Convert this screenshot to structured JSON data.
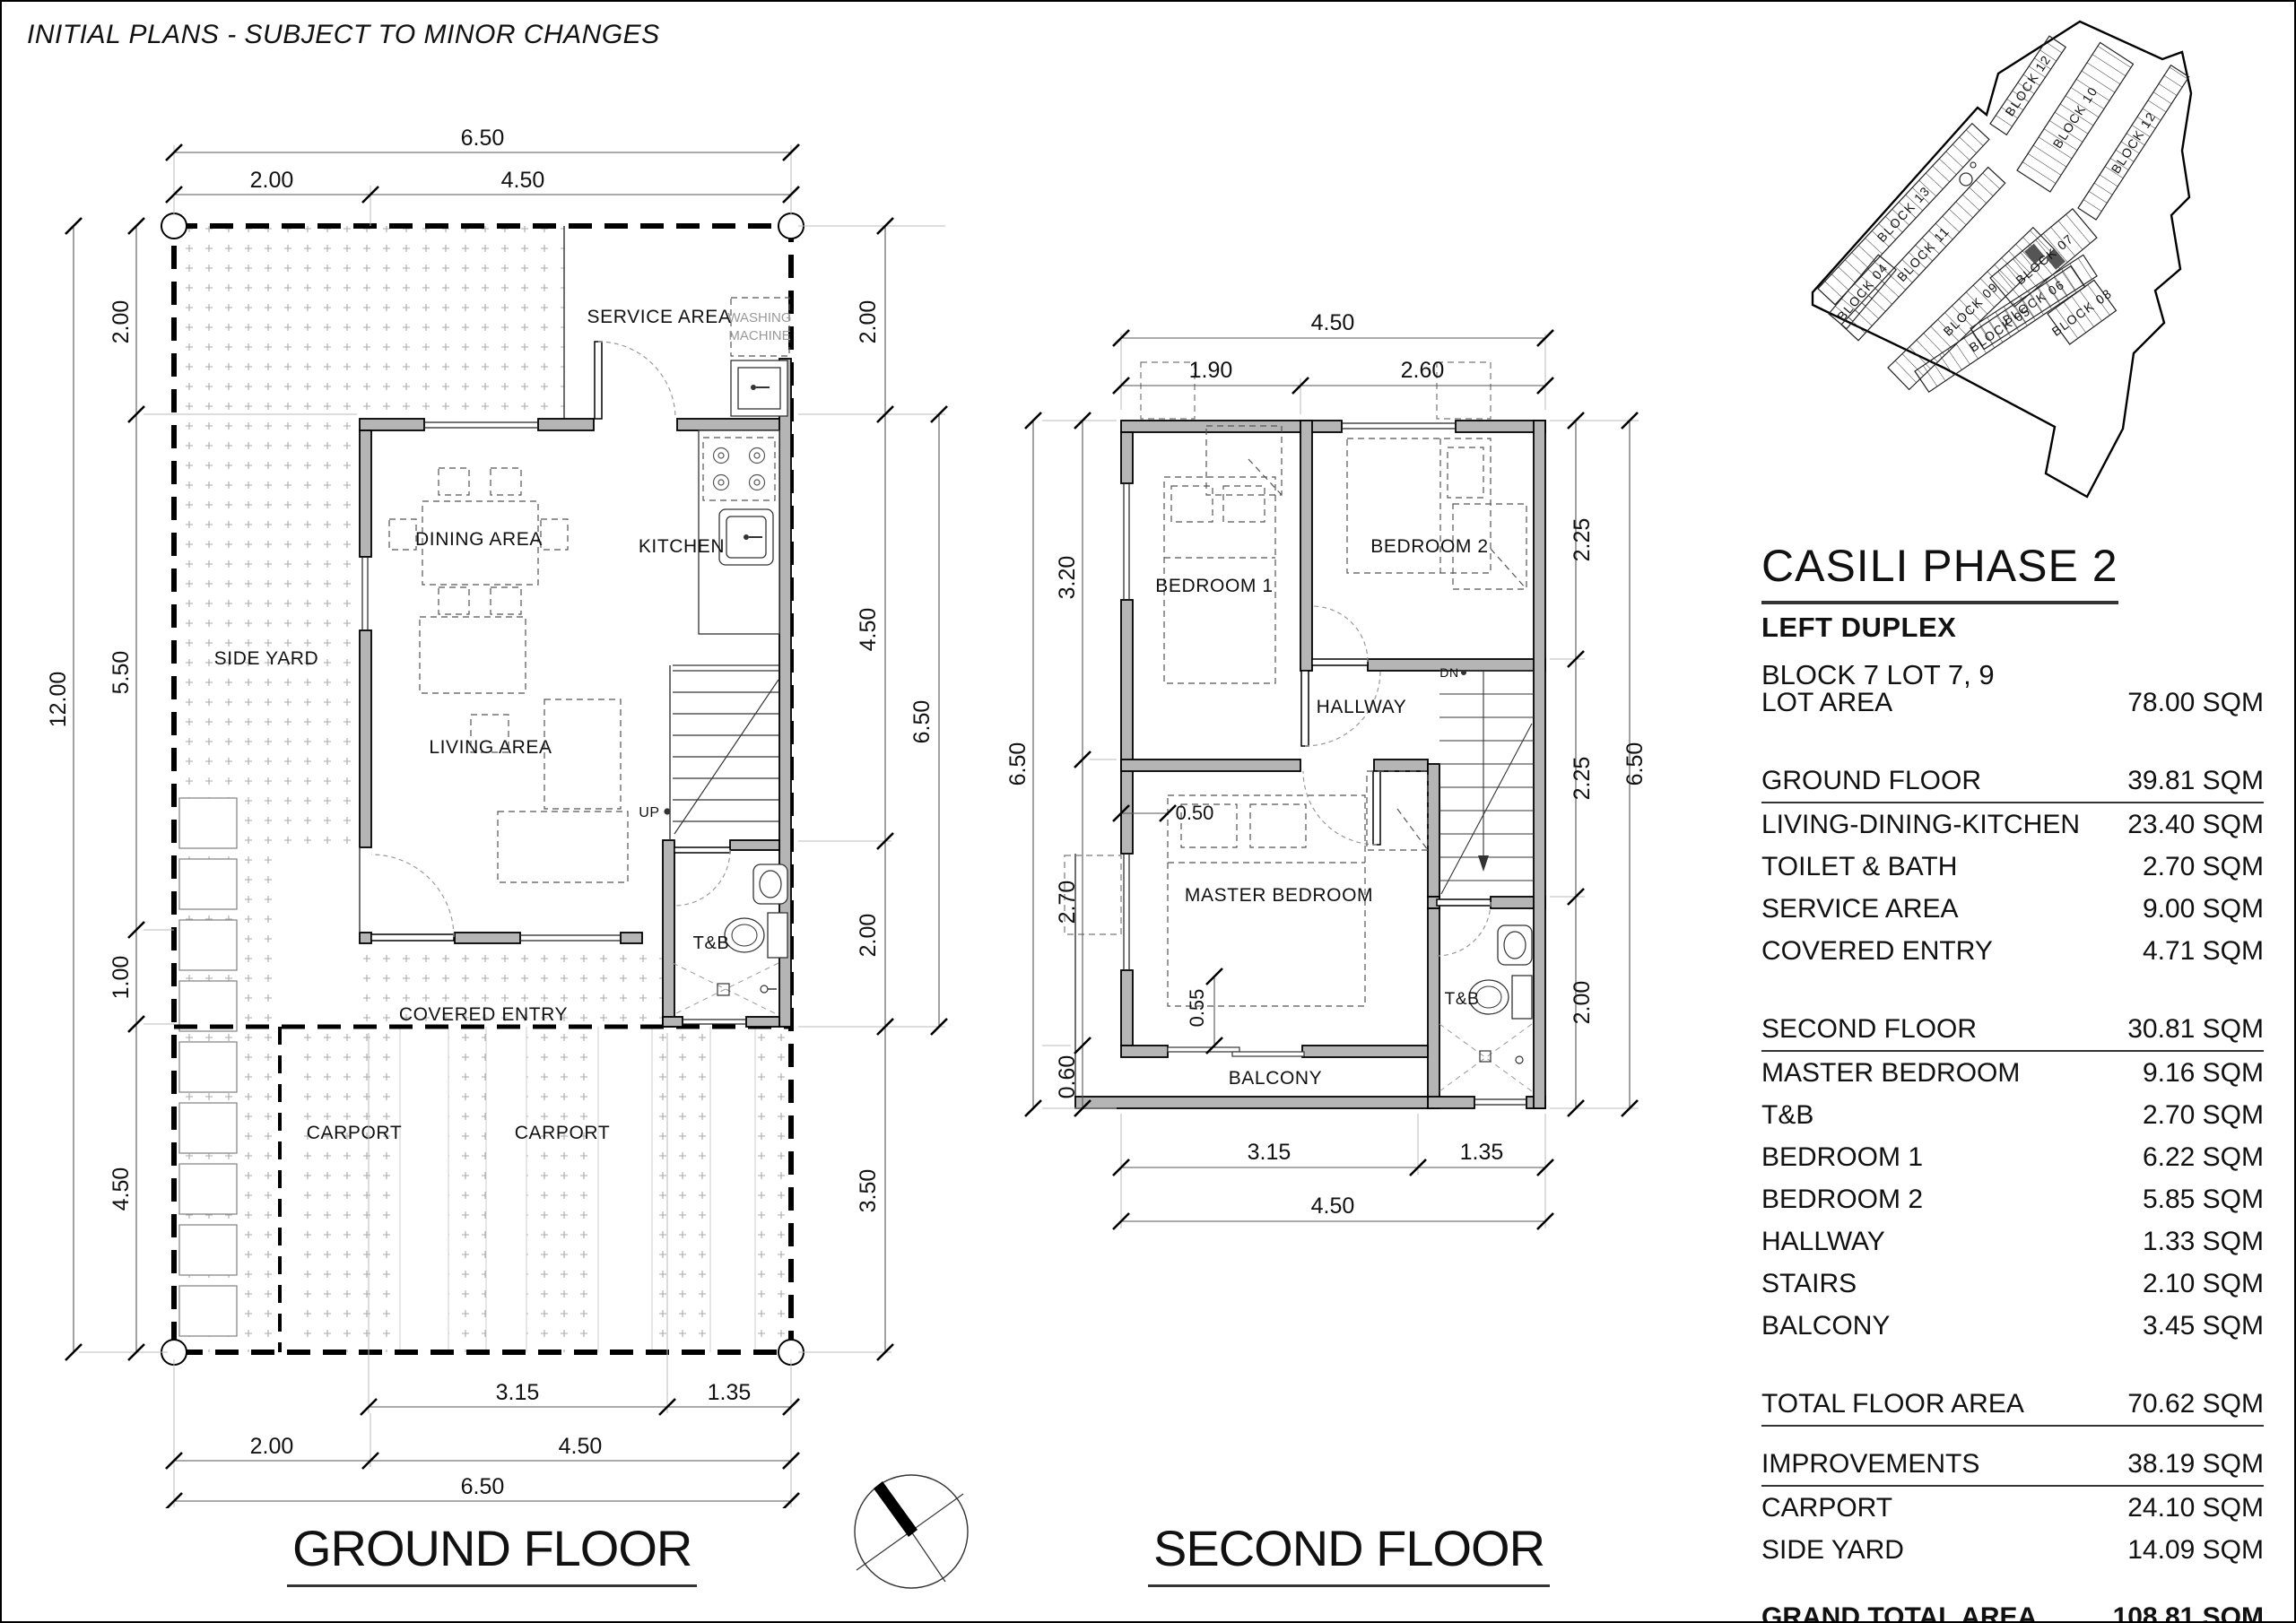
{
  "disclaimer": "INITIAL PLANS - SUBJECT TO MINOR CHANGES",
  "panel": {
    "title": "CASILI PHASE 2",
    "subtitle": "LEFT DUPLEX",
    "block_lot": "BLOCK 7 LOT 7, 9"
  },
  "table": {
    "rows": [
      {
        "label": "LOT AREA",
        "value": "78.00 SQM"
      },
      {
        "label": "GROUND FLOOR",
        "value": "39.81 SQM"
      },
      {
        "label": "LIVING-DINING-KITCHEN",
        "value": "23.40 SQM"
      },
      {
        "label": "TOILET & BATH",
        "value": "2.70 SQM"
      },
      {
        "label": "SERVICE AREA",
        "value": "9.00 SQM"
      },
      {
        "label": "COVERED ENTRY",
        "value": "4.71 SQM"
      },
      {
        "label": "SECOND FLOOR",
        "value": "30.81 SQM"
      },
      {
        "label": "MASTER BEDROOM",
        "value": "9.16 SQM"
      },
      {
        "label": "T&B",
        "value": "2.70 SQM"
      },
      {
        "label": "BEDROOM 1",
        "value": "6.22 SQM"
      },
      {
        "label": "BEDROOM 2",
        "value": "5.85 SQM"
      },
      {
        "label": "HALLWAY",
        "value": "1.33 SQM"
      },
      {
        "label": "STAIRS",
        "value": "2.10 SQM"
      },
      {
        "label": "BALCONY",
        "value": "3.45 SQM"
      },
      {
        "label": "TOTAL FLOOR AREA",
        "value": "70.62 SQM"
      },
      {
        "label": "IMPROVEMENTS",
        "value": "38.19 SQM"
      },
      {
        "label": "CARPORT",
        "value": "24.10 SQM"
      },
      {
        "label": "SIDE YARD",
        "value": "14.09 SQM"
      },
      {
        "label": "GRAND TOTAL AREA",
        "value": "108.81 SQM"
      }
    ]
  },
  "ground_floor": {
    "title": "GROUND FLOOR",
    "rooms": {
      "service_area": "SERVICE AREA",
      "washing_1": "WASHING",
      "washing_2": "MACHINE",
      "dining": "DINING AREA",
      "kitchen": "KITCHEN",
      "side_yard": "SIDE YARD",
      "living": "LIVING AREA",
      "up": "UP",
      "tnb": "T&B",
      "covered_entry": "COVERED ENTRY",
      "carport_a": "CARPORT",
      "carport_b": "CARPORT"
    },
    "dims": {
      "t_all": "6.50",
      "t1": "2.00",
      "t2": "4.50",
      "l_all": "12.00",
      "l1": "2.00",
      "l2": "5.50",
      "l3": "1.00",
      "l4": "4.50",
      "r1": "2.00",
      "r2": "4.50",
      "r_all": "6.50",
      "r3": "2.00",
      "r4": "3.50",
      "b1": "3.15",
      "b2": "1.35",
      "b3": "2.00",
      "b4": "4.50",
      "b_all": "6.50"
    }
  },
  "second_floor": {
    "title": "SECOND FLOOR",
    "rooms": {
      "bedroom1": "BEDROOM 1",
      "bedroom2": "BEDROOM 2",
      "hallway": "HALLWAY",
      "master": "MASTER BEDROOM",
      "balcony": "BALCONY",
      "tnb": "T&B",
      "dn": "DN"
    },
    "dims": {
      "t_all": "4.50",
      "t1": "1.90",
      "t2": "2.60",
      "l1": "3.20",
      "l2": "2.70",
      "l3": "0.60",
      "l_all": "6.50",
      "r1": "2.25",
      "r2": "2.25",
      "r3": "2.00",
      "r_all": "6.50",
      "b1": "3.15",
      "b2": "1.35",
      "b_all": "4.50",
      "i1": "0.50",
      "i2": "0.55"
    }
  },
  "site_map": {
    "blocks": [
      "BLOCK 13",
      "BLOCK 11",
      "BLOCK 12",
      "BLOCK 10",
      "BLOCK 12",
      "BLOCK 09",
      "BLOCK 08",
      "BLOCK 07",
      "BLOCK 06",
      "BLOCK 05",
      "BLOCK 04"
    ]
  }
}
